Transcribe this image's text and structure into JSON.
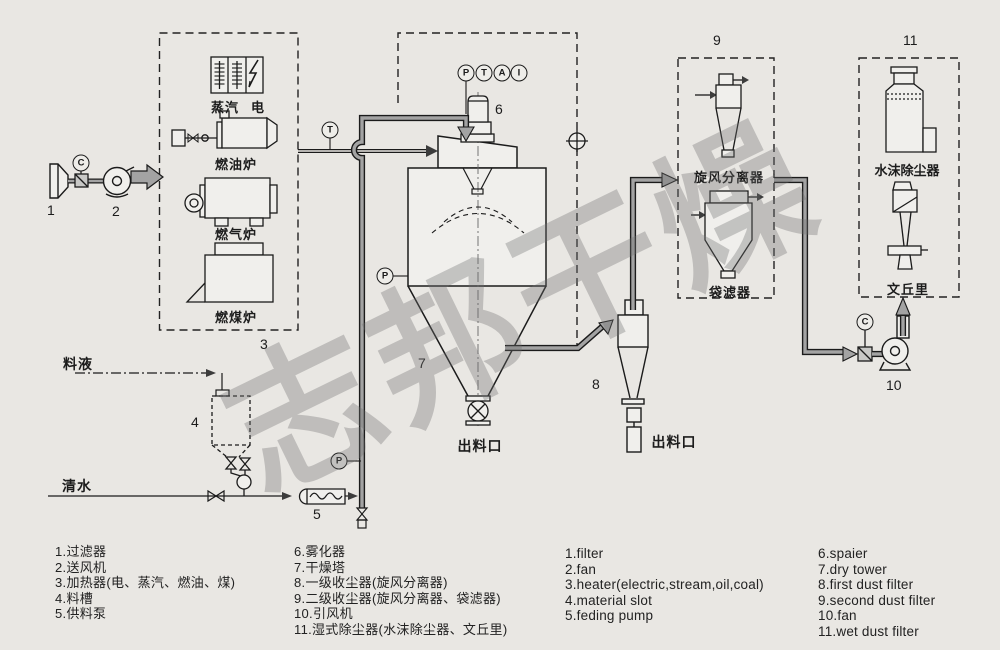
{
  "watermark": "志邦干燥",
  "instruments": {
    "p": "P",
    "t": "T",
    "a": "A",
    "i": "I",
    "c": "C"
  },
  "equipment_numbers": {
    "n1": "1",
    "n2": "2",
    "n3": "3",
    "n4": "4",
    "n5": "5",
    "n6": "6",
    "n7": "7",
    "n8": "8",
    "n9": "9",
    "n10": "10",
    "n11": "11"
  },
  "component_labels": {
    "steam": "蒸汽",
    "electric": "电",
    "oil_furnace": "燃油炉",
    "gas_furnace": "燃气炉",
    "coal_furnace": "燃煤炉",
    "cyclone_separator": "旋风分离器",
    "bag_filter": "袋滤器",
    "water_spray_duster": "水沫除尘器",
    "venturi": "文丘里",
    "feed_liquid": "料液",
    "clean_water": "清水",
    "tower_outlet": "出料口",
    "cyclone_outlet": "出料口"
  },
  "legend": {
    "col1": [
      "1.过滤器",
      "2.送风机",
      "3.加热器(电、蒸汽、燃油、煤)",
      "4.料槽",
      "5.供料泵"
    ],
    "col2": [
      "6.雾化器",
      "7.干燥塔",
      "8.一级收尘器(旋风分离器)",
      "9.二级收尘器(旋风分离器、袋滤器)",
      "10.引风机",
      "11.湿式除尘器(水沫除尘器、文丘里)"
    ],
    "col3": [
      "1.filter",
      "2.fan",
      "3.heater(electric,stream,oil,coal)",
      "4.material slot",
      "5.feding pump"
    ],
    "col4": [
      "6.spaier",
      "7.dry tower",
      "8.first dust filter",
      "9.second dust filter",
      "10.fan",
      "11.wet dust filter"
    ]
  },
  "colors": {
    "paper": "#e9e7e3",
    "line": "#1b1b1b",
    "pipe_fill": "#a3a3a3",
    "equipment_fill": "#f0efec",
    "watermark": "#6f6f6f"
  }
}
